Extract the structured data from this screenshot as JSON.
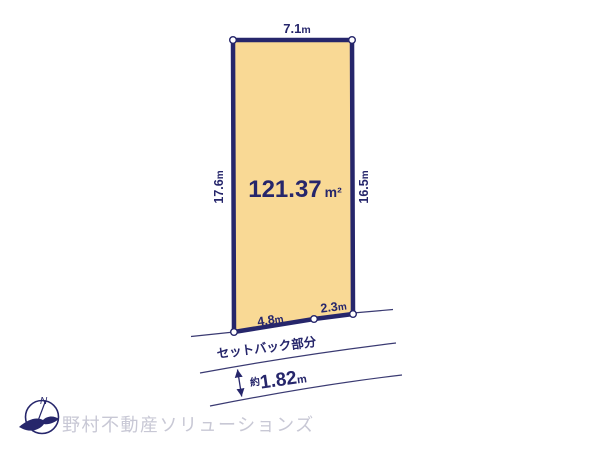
{
  "diagram": {
    "plot": {
      "area": {
        "value": "121.37",
        "unit": "m²"
      },
      "dim_top": {
        "value": "7.1",
        "unit": "m"
      },
      "dim_left": {
        "value": "17.6",
        "unit": "m"
      },
      "dim_right": {
        "value": "16.5",
        "unit": "m"
      },
      "dim_bottom_left": {
        "value": "4.8",
        "unit": "m"
      },
      "dim_bottom_right": {
        "value": "2.3",
        "unit": "m"
      }
    },
    "setback": {
      "label": "セットバック部分",
      "approx_prefix": "約",
      "value": "1.82",
      "unit": "m"
    },
    "compass": {
      "north_label": "N"
    },
    "watermark": "野村不動産ソリューションズ",
    "colors": {
      "plot_fill": "#F9D995",
      "plot_border": "#26266B",
      "line": "#3A3A72",
      "text": "#26266B",
      "watermark": "#C8C8D5"
    }
  }
}
